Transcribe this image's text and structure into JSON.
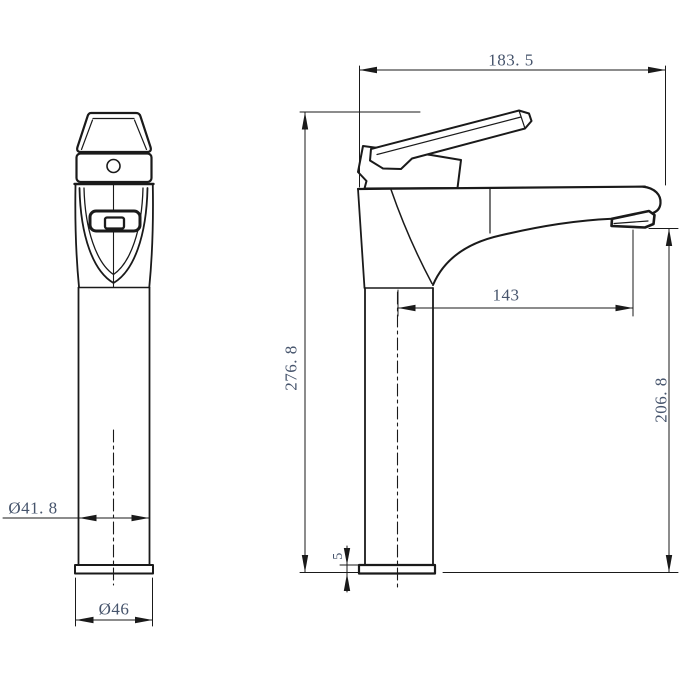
{
  "drawing": {
    "colors": {
      "line": "#1a1a1a",
      "dim_text": "#46546c",
      "background": "#ffffff"
    },
    "views": {
      "front": {
        "labels": {
          "body_diameter": "Ø41. 8",
          "base_diameter": "Ø46"
        }
      },
      "side": {
        "labels": {
          "overall_width": "183. 5",
          "overall_height": "276. 8",
          "spout_reach": "143",
          "spout_outlet_height": "206. 8",
          "base_plate_thickness": "5"
        }
      }
    }
  }
}
